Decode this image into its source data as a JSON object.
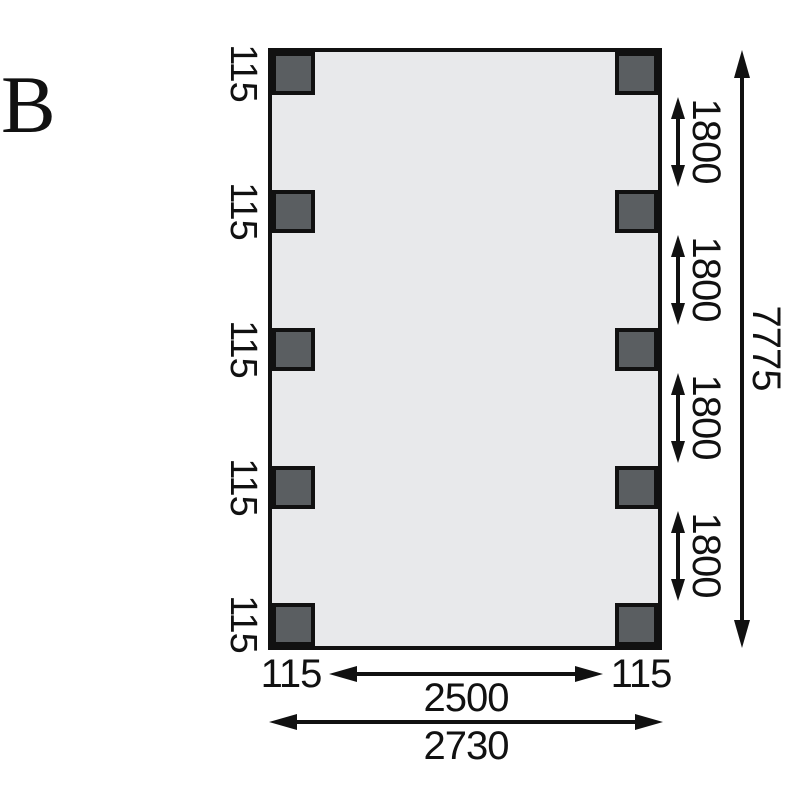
{
  "figure_label": "B",
  "drawing": {
    "post_width_labels_left": [
      "115",
      "115",
      "115",
      "115",
      "115"
    ],
    "bay_spacing_labels": [
      "1800",
      "1800",
      "1800",
      "1800"
    ],
    "overall_depth_label": "7775",
    "post_width_label_bottom_left": "115",
    "post_width_label_bottom_right": "115",
    "inner_width_label": "2500",
    "overall_width_label": "2730"
  },
  "colors": {
    "line": "#111111",
    "slab_fill": "#e8e9eb",
    "post_fill": "#5a5e61"
  }
}
